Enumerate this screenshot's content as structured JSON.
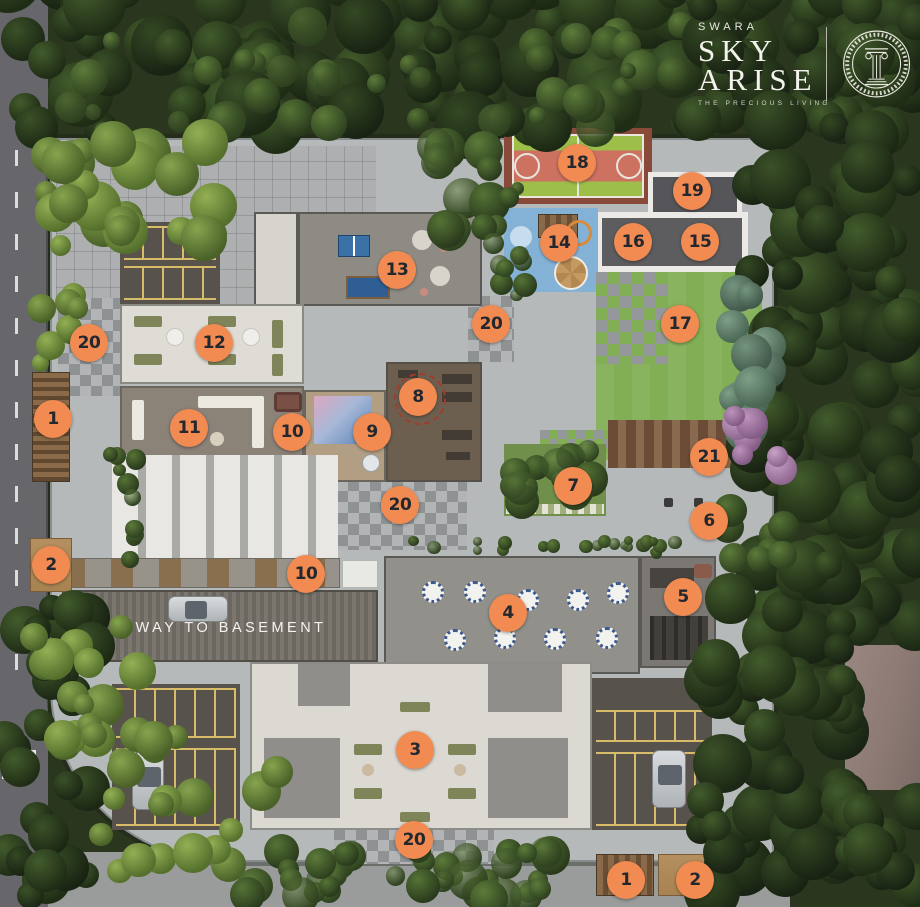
{
  "header": {
    "brand": "SWARA",
    "title_word1": "SKY",
    "title_word2": "ARISE",
    "tagline": "THE PRECIOUS LIVING",
    "emblem_icon": "greek-column-medallion"
  },
  "site_plan": {
    "basement_label": "WAY TO BASEMENT",
    "marker_style": {
      "bg": "#F18B52",
      "text": "#23272E"
    },
    "markers": [
      {
        "label": "18",
        "x": 577,
        "y": 163
      },
      {
        "label": "19",
        "x": 692,
        "y": 191
      },
      {
        "label": "14",
        "x": 559,
        "y": 243
      },
      {
        "label": "16",
        "x": 633,
        "y": 242
      },
      {
        "label": "15",
        "x": 700,
        "y": 242
      },
      {
        "label": "13",
        "x": 397,
        "y": 270
      },
      {
        "label": "20",
        "x": 491,
        "y": 324
      },
      {
        "label": "17",
        "x": 680,
        "y": 324
      },
      {
        "label": "12",
        "x": 214,
        "y": 343
      },
      {
        "label": "20",
        "x": 89,
        "y": 343
      },
      {
        "label": "8",
        "x": 418,
        "y": 397
      },
      {
        "label": "1",
        "x": 53,
        "y": 419
      },
      {
        "label": "11",
        "x": 189,
        "y": 428
      },
      {
        "label": "10",
        "x": 292,
        "y": 432
      },
      {
        "label": "9",
        "x": 372,
        "y": 432
      },
      {
        "label": "21",
        "x": 709,
        "y": 457
      },
      {
        "label": "7",
        "x": 573,
        "y": 486
      },
      {
        "label": "20",
        "x": 400,
        "y": 505
      },
      {
        "label": "6",
        "x": 709,
        "y": 521
      },
      {
        "label": "2",
        "x": 51,
        "y": 565
      },
      {
        "label": "10",
        "x": 306,
        "y": 574
      },
      {
        "label": "5",
        "x": 683,
        "y": 597
      },
      {
        "label": "4",
        "x": 508,
        "y": 613
      },
      {
        "label": "3",
        "x": 415,
        "y": 750
      },
      {
        "label": "20",
        "x": 414,
        "y": 840
      },
      {
        "label": "1",
        "x": 626,
        "y": 880
      },
      {
        "label": "2",
        "x": 695,
        "y": 880
      }
    ]
  }
}
